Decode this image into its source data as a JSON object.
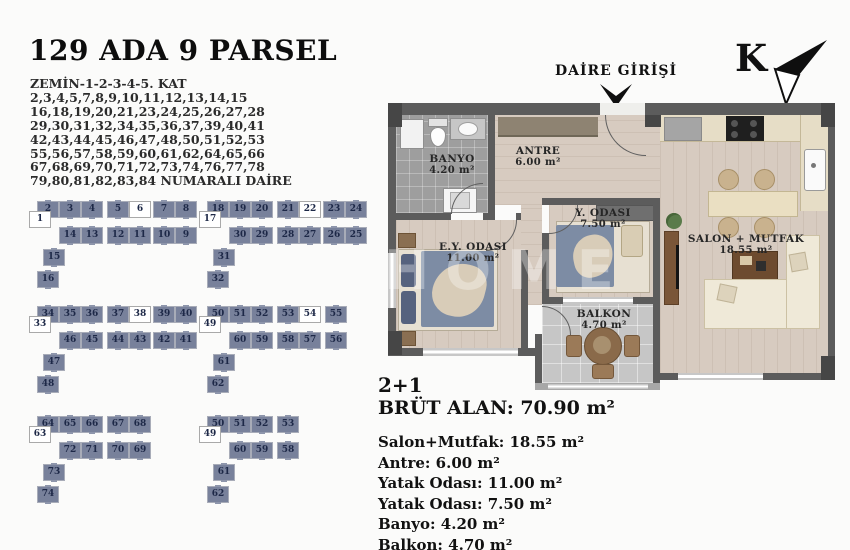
{
  "title": "129 ADA 9 PARSEL",
  "subtitle_lines": [
    "ZEMİN-1-2-3-4-5. KAT",
    "2,3,4,5,7,8,9,10,11,12,13,14,15",
    "16,18,19,20,21,23,24,25,26,27,28",
    "29,30,31,32,34,35,36,37,39,40,41",
    "42,43,44,45,46,47,48,50,51,52,53",
    "55,56,57,58,59,60,61,62,64,65,66",
    "67,68,69,70,71,72,73,74,76,77,78",
    "79,80,81,82,83,84 NUMARALI DAİRE"
  ],
  "compass_label": "K",
  "entrance_label": "DAİRE GİRİŞİ",
  "watermark": "HOME",
  "colors": {
    "box": "#78819b",
    "boxnum": "#1d2847",
    "wall": "#5c5c5c",
    "wood": "#d7cbc0",
    "tile": "#9e9e9e",
    "balk": "#c6c6c6"
  },
  "keyplan": {
    "groups": [
      {
        "id": "1",
        "origin": {
          "x": 30,
          "y": 202
        },
        "boxes": [
          {
            "n": "2",
            "x": 8,
            "y": 0
          },
          {
            "n": "3",
            "x": 30,
            "y": 0
          },
          {
            "n": "4",
            "x": 52,
            "y": 0
          },
          {
            "n": "5",
            "x": 78,
            "y": 0
          },
          {
            "n": "6",
            "x": 100,
            "y": 0,
            "white": true
          },
          {
            "n": "7",
            "x": 124,
            "y": 0
          },
          {
            "n": "8",
            "x": 146,
            "y": 0
          },
          {
            "n": "1",
            "x": 0,
            "y": 10,
            "white": true
          },
          {
            "n": "14",
            "x": 30,
            "y": 26
          },
          {
            "n": "13",
            "x": 52,
            "y": 26
          },
          {
            "n": "12",
            "x": 78,
            "y": 26
          },
          {
            "n": "11",
            "x": 100,
            "y": 26
          },
          {
            "n": "10",
            "x": 124,
            "y": 26
          },
          {
            "n": "9",
            "x": 146,
            "y": 26
          },
          {
            "n": "15",
            "x": 14,
            "y": 48
          },
          {
            "n": "16",
            "x": 8,
            "y": 70
          }
        ]
      },
      {
        "id": "2",
        "origin": {
          "x": 200,
          "y": 202
        },
        "boxes": [
          {
            "n": "18",
            "x": 8,
            "y": 0
          },
          {
            "n": "19",
            "x": 30,
            "y": 0
          },
          {
            "n": "20",
            "x": 52,
            "y": 0
          },
          {
            "n": "21",
            "x": 78,
            "y": 0
          },
          {
            "n": "22",
            "x": 100,
            "y": 0,
            "white": true
          },
          {
            "n": "23",
            "x": 124,
            "y": 0
          },
          {
            "n": "24",
            "x": 146,
            "y": 0
          },
          {
            "n": "17",
            "x": 0,
            "y": 10,
            "white": true
          },
          {
            "n": "30",
            "x": 30,
            "y": 26
          },
          {
            "n": "29",
            "x": 52,
            "y": 26
          },
          {
            "n": "28",
            "x": 78,
            "y": 26
          },
          {
            "n": "27",
            "x": 100,
            "y": 26
          },
          {
            "n": "26",
            "x": 124,
            "y": 26
          },
          {
            "n": "25",
            "x": 146,
            "y": 26
          },
          {
            "n": "31",
            "x": 14,
            "y": 48
          },
          {
            "n": "32",
            "x": 8,
            "y": 70
          }
        ]
      },
      {
        "id": "3",
        "origin": {
          "x": 30,
          "y": 307
        },
        "boxes": [
          {
            "n": "34",
            "x": 8,
            "y": 0
          },
          {
            "n": "35",
            "x": 30,
            "y": 0
          },
          {
            "n": "36",
            "x": 52,
            "y": 0
          },
          {
            "n": "37",
            "x": 78,
            "y": 0
          },
          {
            "n": "38",
            "x": 100,
            "y": 0,
            "white": true
          },
          {
            "n": "39",
            "x": 124,
            "y": 0
          },
          {
            "n": "40",
            "x": 146,
            "y": 0
          },
          {
            "n": "33",
            "x": 0,
            "y": 10,
            "white": true
          },
          {
            "n": "46",
            "x": 30,
            "y": 26
          },
          {
            "n": "45",
            "x": 52,
            "y": 26
          },
          {
            "n": "44",
            "x": 78,
            "y": 26
          },
          {
            "n": "43",
            "x": 100,
            "y": 26
          },
          {
            "n": "42",
            "x": 124,
            "y": 26
          },
          {
            "n": "41",
            "x": 146,
            "y": 26
          },
          {
            "n": "47",
            "x": 14,
            "y": 48
          },
          {
            "n": "48",
            "x": 8,
            "y": 70
          }
        ]
      },
      {
        "id": "4",
        "origin": {
          "x": 200,
          "y": 307
        },
        "boxes": [
          {
            "n": "50",
            "x": 8,
            "y": 0
          },
          {
            "n": "51",
            "x": 30,
            "y": 0
          },
          {
            "n": "52",
            "x": 52,
            "y": 0
          },
          {
            "n": "53",
            "x": 78,
            "y": 0
          },
          {
            "n": "54",
            "x": 100,
            "y": 0,
            "white": true
          },
          {
            "n": "55",
            "x": 126,
            "y": 0
          },
          {
            "n": "49",
            "x": 0,
            "y": 10,
            "white": true
          },
          {
            "n": "60",
            "x": 30,
            "y": 26
          },
          {
            "n": "59",
            "x": 52,
            "y": 26
          },
          {
            "n": "58",
            "x": 78,
            "y": 26
          },
          {
            "n": "57",
            "x": 100,
            "y": 26
          },
          {
            "n": "56",
            "x": 126,
            "y": 26
          },
          {
            "n": "61",
            "x": 14,
            "y": 48
          },
          {
            "n": "62",
            "x": 8,
            "y": 70
          }
        ]
      },
      {
        "id": "5",
        "origin": {
          "x": 30,
          "y": 417
        },
        "boxes": [
          {
            "n": "64",
            "x": 8,
            "y": 0
          },
          {
            "n": "65",
            "x": 30,
            "y": 0
          },
          {
            "n": "66",
            "x": 52,
            "y": 0
          },
          {
            "n": "67",
            "x": 78,
            "y": 0
          },
          {
            "n": "68",
            "x": 100,
            "y": 0
          },
          {
            "n": "63",
            "x": 0,
            "y": 10,
            "white": true
          },
          {
            "n": "72",
            "x": 30,
            "y": 26
          },
          {
            "n": "71",
            "x": 52,
            "y": 26
          },
          {
            "n": "70",
            "x": 78,
            "y": 26
          },
          {
            "n": "69",
            "x": 100,
            "y": 26
          },
          {
            "n": "73",
            "x": 14,
            "y": 48
          },
          {
            "n": "74",
            "x": 8,
            "y": 70
          }
        ]
      },
      {
        "id": "6",
        "origin": {
          "x": 200,
          "y": 417
        },
        "boxes": [
          {
            "n": "50",
            "x": 8,
            "y": 0
          },
          {
            "n": "51",
            "x": 30,
            "y": 0
          },
          {
            "n": "52",
            "x": 52,
            "y": 0
          },
          {
            "n": "53",
            "x": 78,
            "y": 0
          },
          {
            "n": "49",
            "x": 0,
            "y": 10,
            "white": true
          },
          {
            "n": "60",
            "x": 30,
            "y": 26
          },
          {
            "n": "59",
            "x": 52,
            "y": 26
          },
          {
            "n": "58",
            "x": 78,
            "y": 26
          },
          {
            "n": "61",
            "x": 14,
            "y": 48
          },
          {
            "n": "62",
            "x": 8,
            "y": 70
          }
        ]
      }
    ]
  },
  "floorplan": {
    "rooms": [
      {
        "id": "banyo",
        "name": "BANYO",
        "area": "4.20 m²"
      },
      {
        "id": "antre",
        "name": "ANTRE",
        "area": "6.00 m²"
      },
      {
        "id": "ey-odasi",
        "name": "E.Y. ODASI",
        "area": "11.00 m²"
      },
      {
        "id": "y-odasi",
        "name": "Y. ODASI",
        "area": "7.50 m²"
      },
      {
        "id": "balkon",
        "name": "BALKON",
        "area": "4.70 m²"
      },
      {
        "id": "salon-mutfak",
        "name": "SALON + MUTFAK",
        "area": "18.55 m²"
      }
    ]
  },
  "summary": {
    "type_label": "2+1",
    "gross_area_line": "BRÜT ALAN: 70.90 m²",
    "rooms": [
      {
        "name": "Salon+Mutfak",
        "area": "18.55 m²",
        "line": "Salon+Mutfak: 18.55 m²"
      },
      {
        "name": "Antre",
        "area": "6.00 m²",
        "line": "Antre: 6.00 m²"
      },
      {
        "name": "Yatak Odası",
        "area": "11.00 m²",
        "line": "Yatak Odası: 11.00 m²"
      },
      {
        "name": "Yatak Odası",
        "area": "7.50 m²",
        "line": "Yatak Odası: 7.50 m²"
      },
      {
        "name": "Banyo",
        "area": "4.20 m²",
        "line": "Banyo: 4.20 m²"
      },
      {
        "name": "Balkon",
        "area": "4.70 m²",
        "line": "Balkon: 4.70 m²"
      }
    ]
  }
}
